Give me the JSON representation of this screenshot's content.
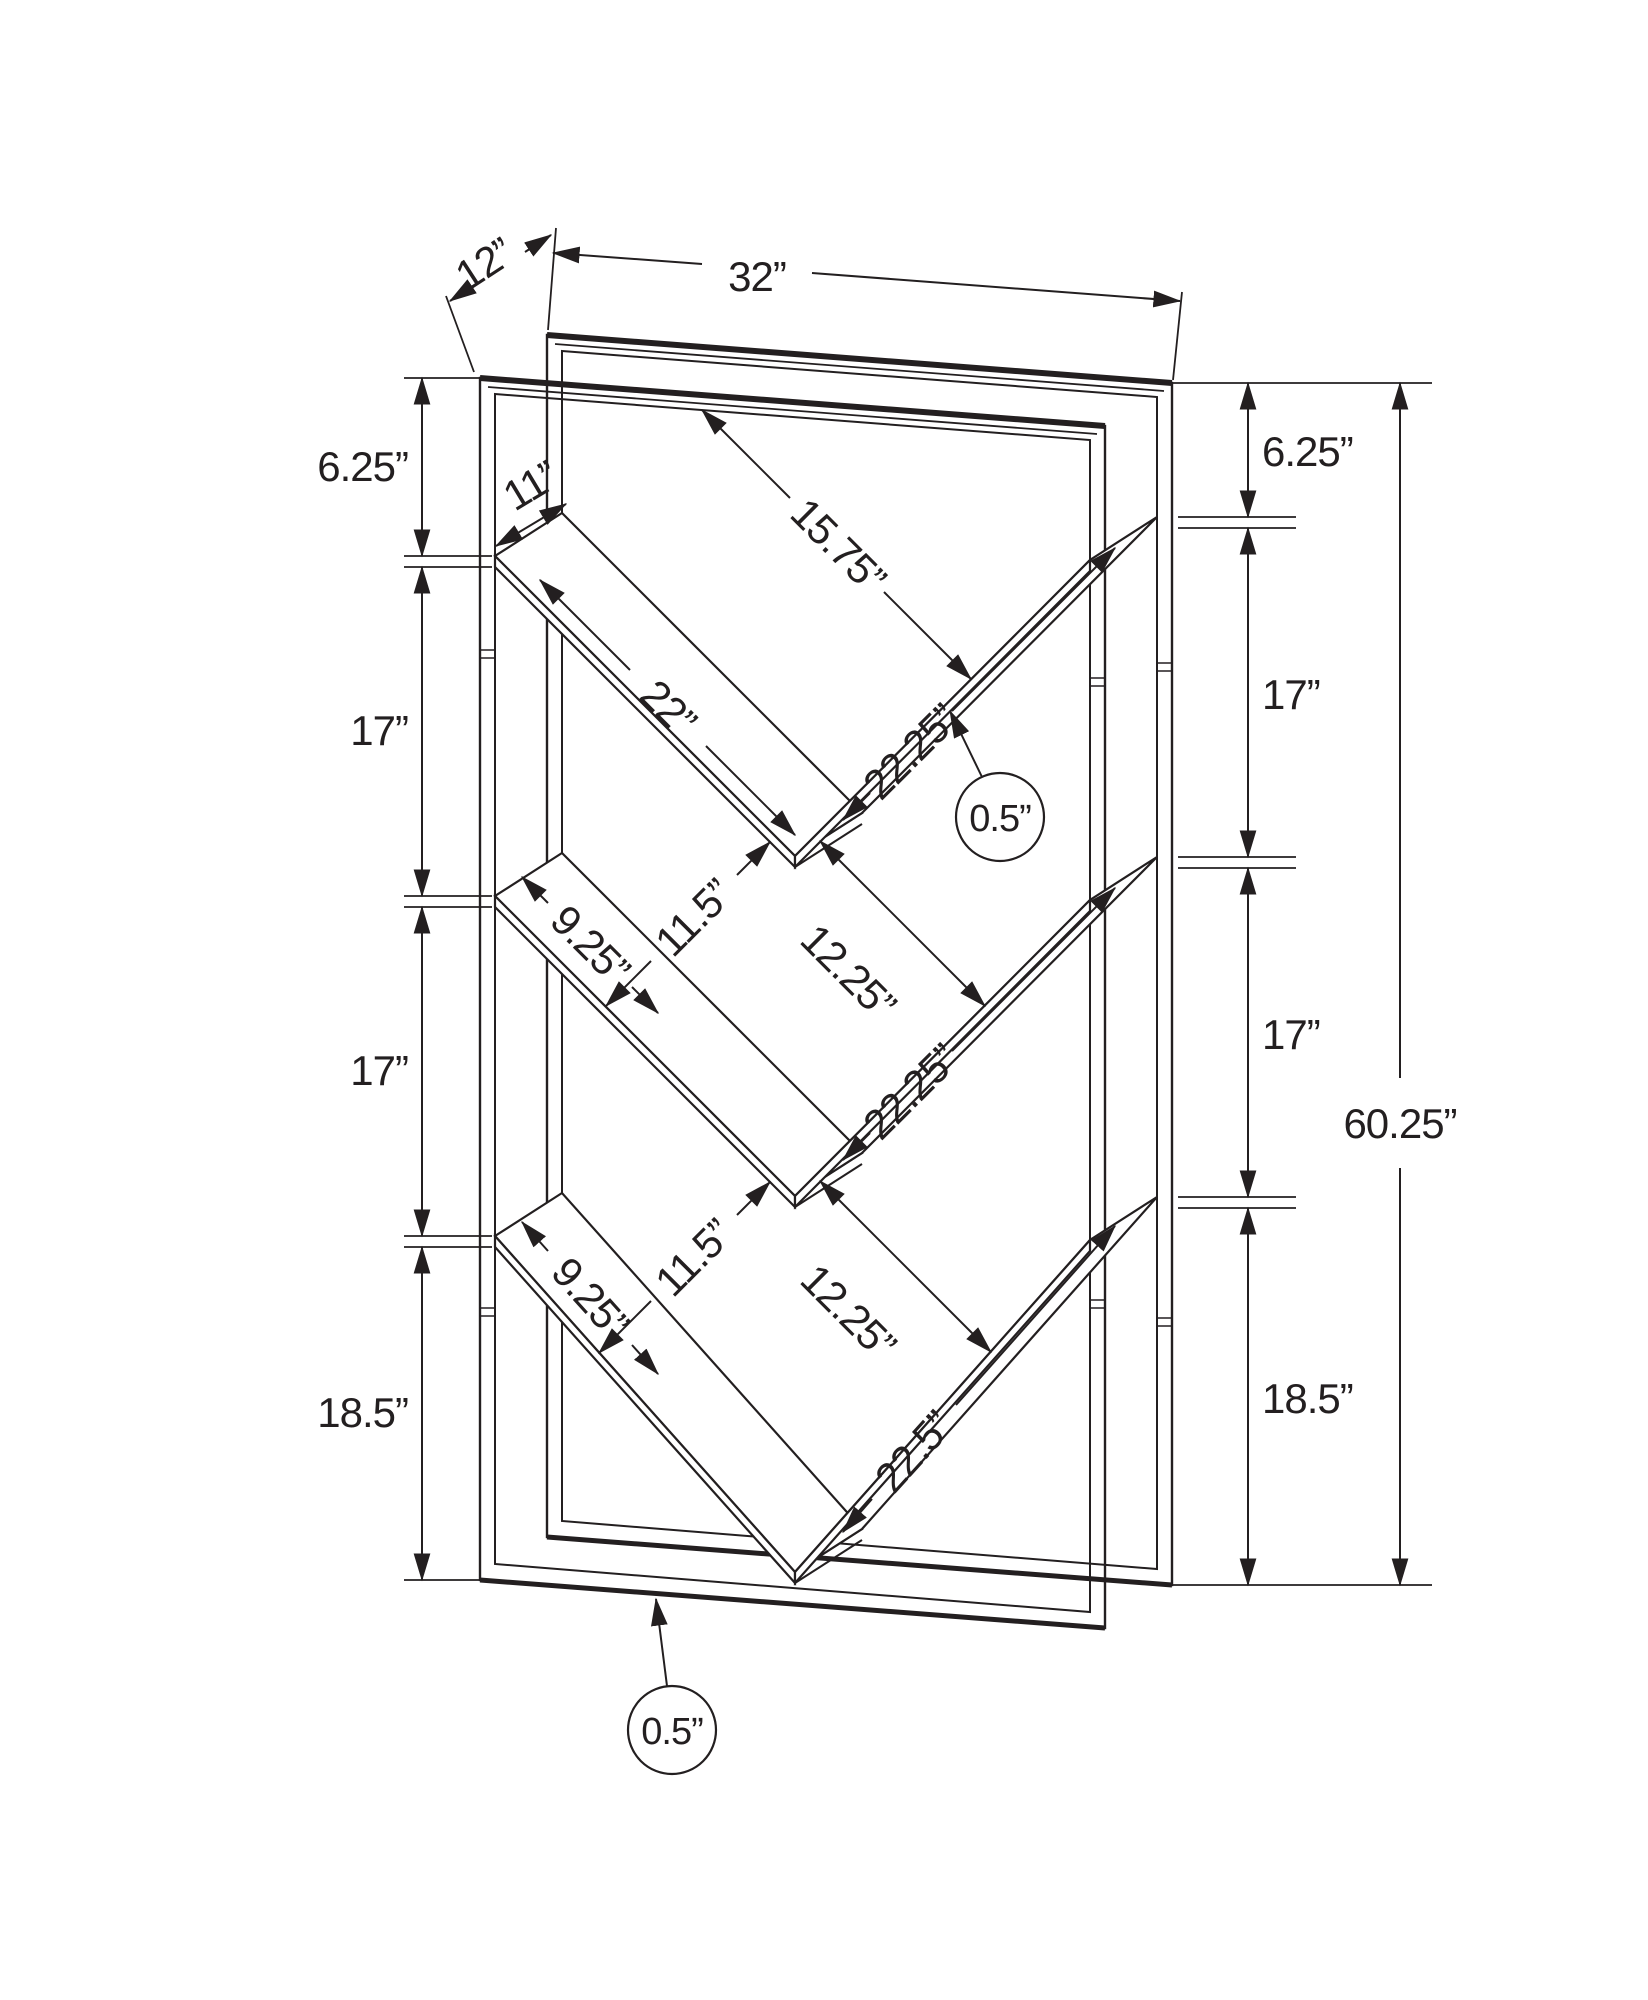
{
  "diagram": {
    "type": "furniture-dimension-drawing",
    "subject": "V-shelf bookcase frame, isometric wireframe with dimension annotations",
    "units": "inches"
  },
  "colors": {
    "line": "#231f20",
    "background": "#ffffff"
  },
  "dims": {
    "depth": "12”",
    "width": "32”",
    "height_total": "60.25”",
    "left_section_1": "6.25”",
    "left_section_2": "17”",
    "left_section_3": "17”",
    "left_section_4": "18.5”",
    "right_section_1": "6.25”",
    "right_section_2": "17”",
    "right_section_3": "17”",
    "right_section_4": "18.5”",
    "top_shelf_depth": "11”",
    "top_opening": "15.75”",
    "top_shelf_length": "22”",
    "middle_shelf_length_1": "22.25”",
    "middle_shelf_length_2": "22.25”",
    "bottom_shelf_length": "22.5”",
    "left_gap_1": "11.5”",
    "left_gap_2": "11.5”",
    "right_gap_1": "12.25”",
    "right_gap_2": "12.25”",
    "left_short_shelf_1": "9.25”",
    "left_short_shelf_2": "9.25”",
    "shelf_thickness_callout": "0.5”",
    "bottom_thickness_callout": "0.5”"
  }
}
